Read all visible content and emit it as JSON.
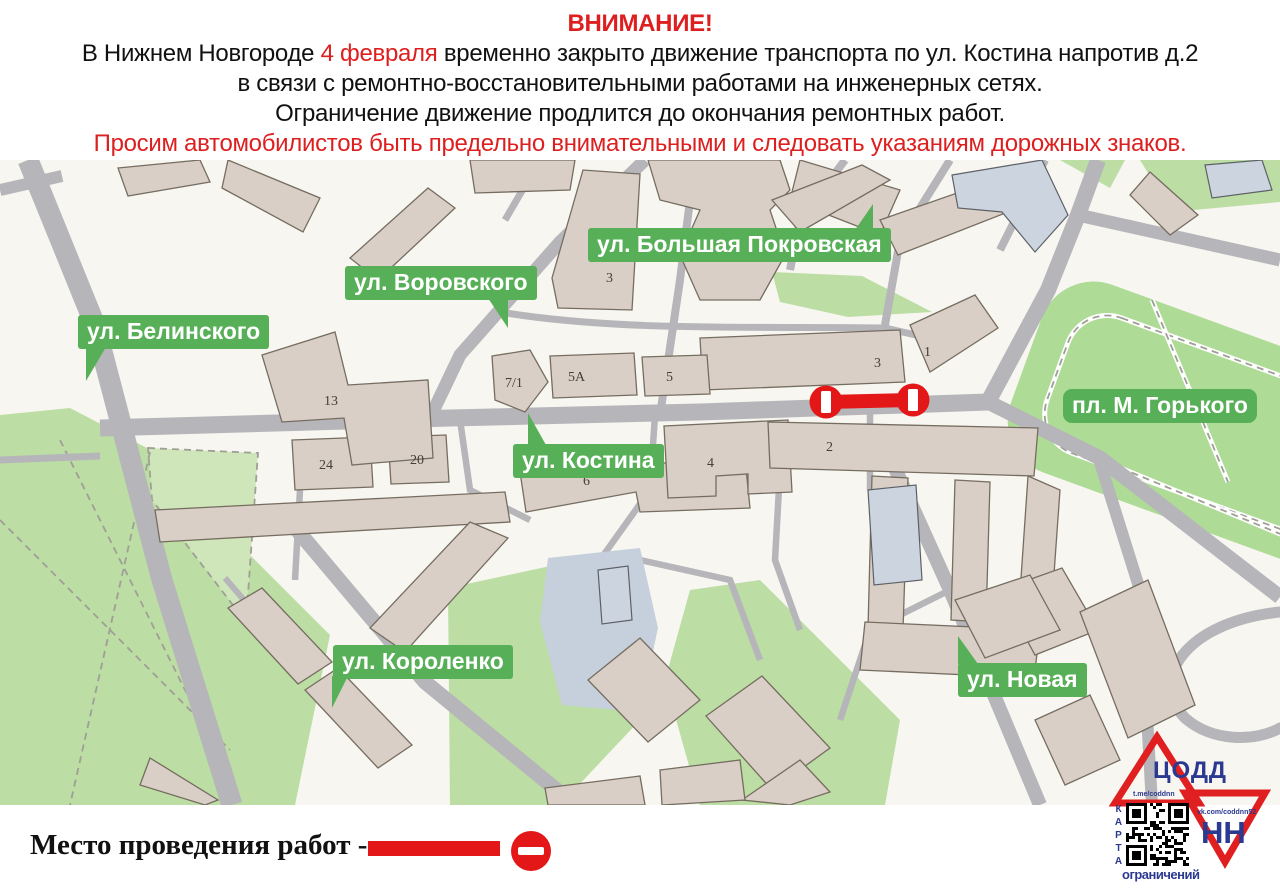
{
  "header": {
    "attention": "ВНИМАНИЕ!",
    "line1_before": "В Нижнем Новгороде",
    "line1_date": "4 февраля",
    "line1_after": "временно закрыто движение транспорта по ул. Костина напротив д.2",
    "line2": "в связи с ремонтно-восстановительными работами на инженерных сетях.",
    "line3": "Ограничение движение продлится до окончания ремонтных работ.",
    "line4": "Просим автомобилистов быть предельно внимательными и следовать указаниям дорожных знаков."
  },
  "map": {
    "labels": {
      "belinskogo": "ул. Белинского",
      "vorovskogo": "ул. Воровского",
      "pokrovskaya": "ул. Большая Покровская",
      "kostina": "ул. Костина",
      "gorkogo": "пл. М. Горького",
      "korolenko": "ул. Короленко",
      "novaya": "ул. Новая"
    },
    "building_numbers": [
      "13",
      "7/1",
      "5А",
      "5",
      "3",
      "3",
      "1",
      "2",
      "24",
      "20",
      "6",
      "4"
    ]
  },
  "legend": {
    "worksite_label": "Место проведения работ -"
  },
  "logo": {
    "org": "ЦОДД",
    "region": "НН",
    "qr_left_text": "КАРТА",
    "qr_bottom_text": "ограничений",
    "telegram": "t.me/coddnn",
    "vk": "vk.com/coddnn52"
  },
  "colors": {
    "badge_green": "#57B057",
    "closure_red": "#E31717",
    "header_red": "#DD1F1F",
    "road_gray": "#B6B5B9",
    "building_fill": "#DACFC6",
    "green_area": "#BCDDA4",
    "logo_blue": "#2B3990",
    "logo_red": "#E02020"
  }
}
